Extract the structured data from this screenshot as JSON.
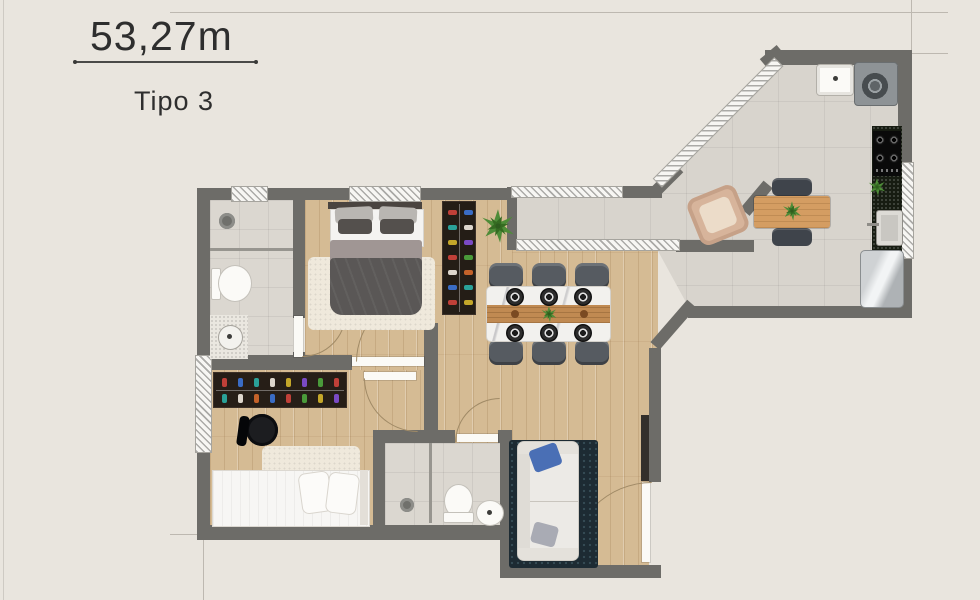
{
  "header": {
    "area_label": "53,27m",
    "type_label": "Tipo 3"
  },
  "palette": {
    "background": "#e9e5de",
    "wall": "#6d6c68",
    "wood_floor": "#d5bb94",
    "tile_floor": "#d8d4cd",
    "text": "#2e2e2e",
    "dark_counter": "#171c12",
    "navy_rug": "#1d2b33",
    "blue_pillow": "#4a6fb5",
    "plant_green": "#4e8c38"
  }
}
